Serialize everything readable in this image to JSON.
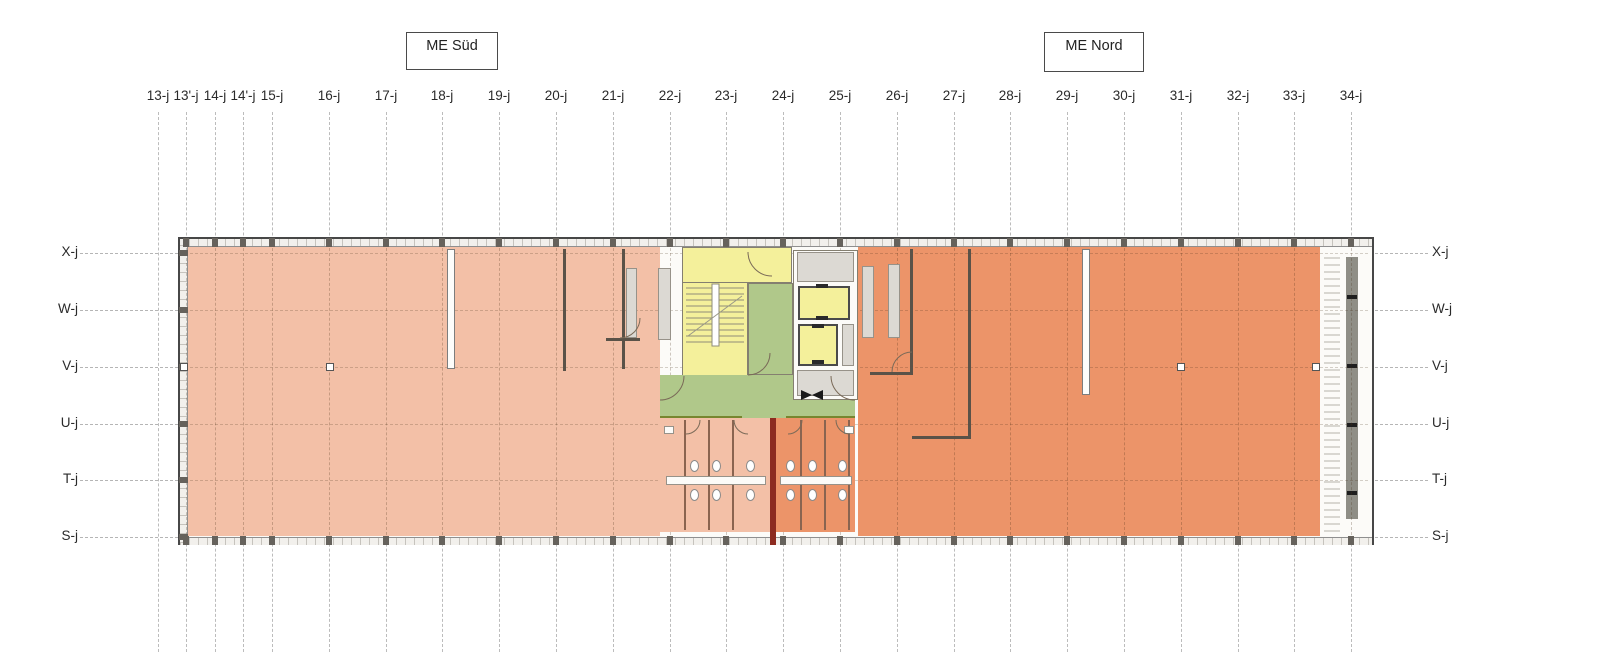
{
  "title_boxes": {
    "sued": "ME Süd",
    "nord": "ME Nord"
  },
  "grid": {
    "columns": [
      "13-j",
      "13'-j",
      "14-j",
      "14'-j",
      "15-j",
      "16-j",
      "17-j",
      "18-j",
      "19-j",
      "20-j",
      "21-j",
      "22-j",
      "23-j",
      "24-j",
      "25-j",
      "26-j",
      "27-j",
      "28-j",
      "29-j",
      "30-j",
      "31-j",
      "32-j",
      "33-j",
      "34-j"
    ],
    "rows": [
      "X-j",
      "W-j",
      "V-j",
      "U-j",
      "T-j",
      "S-j"
    ]
  },
  "colors": {
    "zone_sued": "#f3c0a7",
    "zone_nord": "#ec9469",
    "stair_yellow": "#f4f09b",
    "corridor_green": "#b0c88a",
    "corridor_edge": "#77862f",
    "shaft_gray": "#dcd9d3",
    "fire_wall": "#8d2b20",
    "wall_dark": "#5a5248"
  }
}
